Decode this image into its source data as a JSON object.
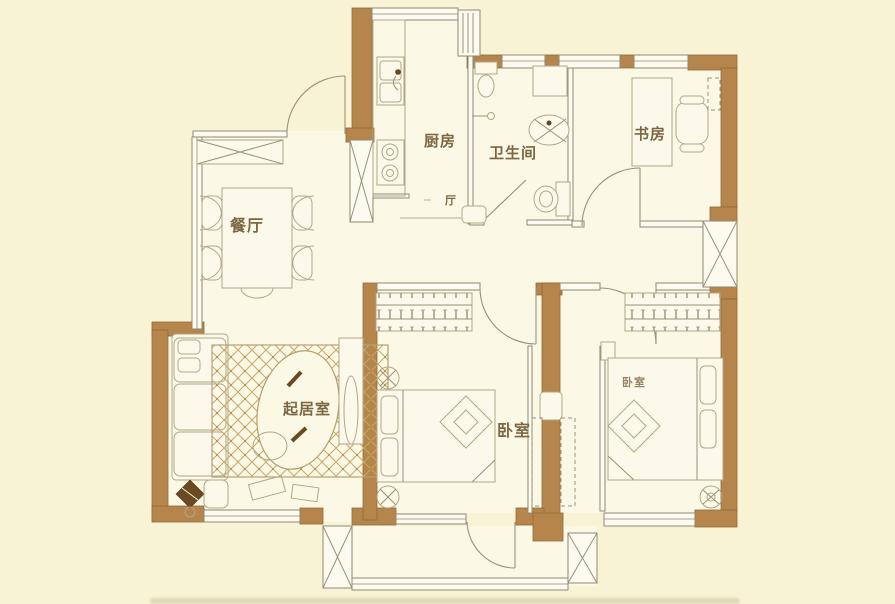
{
  "floorplan": {
    "type": "apartment-floor-plan",
    "labels": {
      "dining": "餐厅",
      "kitchen": "厨房",
      "bathroom": "卫生间",
      "study": "书房",
      "living": "起居室",
      "bedroom_main": "卧室",
      "bedroom_second": "卧室",
      "hall": "厅"
    },
    "colors": {
      "background": "#f8f3d4",
      "floor": "#fbf8e6",
      "wall_brown": "#b5854b",
      "wall_brown_stroke": "#8f6a38",
      "thin_line": "#8f8972",
      "furniture_line": "#b0a887",
      "rug_lattice": "#c8a865",
      "label_text": "#7b6742",
      "dark_accent": "#6b4a22"
    }
  }
}
